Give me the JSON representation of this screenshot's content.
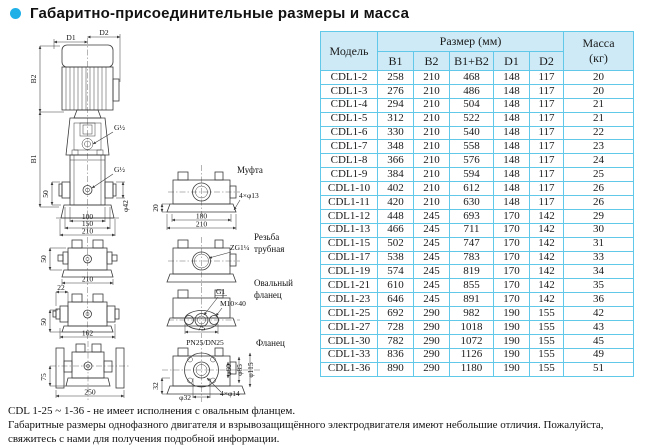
{
  "title": "Габаритно-присоединительные размеры и масса",
  "colors": {
    "accent": "#1fb0e8",
    "table_border": "#62c8ea",
    "header_fill": "#cdeaf6"
  },
  "table": {
    "header": {
      "model": "Модель",
      "size_group": "Размер (мм)",
      "cols": [
        "B1",
        "B2",
        "B1+B2",
        "D1",
        "D2"
      ],
      "mass1": "Масса",
      "mass2": "(кг)"
    },
    "rows": [
      [
        "CDL1-2",
        258,
        210,
        468,
        148,
        117,
        20
      ],
      [
        "CDL1-3",
        276,
        210,
        486,
        148,
        117,
        20
      ],
      [
        "CDL1-4",
        294,
        210,
        504,
        148,
        117,
        21
      ],
      [
        "CDL1-5",
        312,
        210,
        522,
        148,
        117,
        21
      ],
      [
        "CDL1-6",
        330,
        210,
        540,
        148,
        117,
        22
      ],
      [
        "CDL1-7",
        348,
        210,
        558,
        148,
        117,
        23
      ],
      [
        "CDL1-8",
        366,
        210,
        576,
        148,
        117,
        24
      ],
      [
        "CDL1-9",
        384,
        210,
        594,
        148,
        117,
        25
      ],
      [
        "CDL1-10",
        402,
        210,
        612,
        148,
        117,
        26
      ],
      [
        "CDL1-11",
        420,
        210,
        630,
        148,
        117,
        26
      ],
      [
        "CDL1-12",
        448,
        245,
        693,
        170,
        142,
        29
      ],
      [
        "CDL1-13",
        466,
        245,
        711,
        170,
        142,
        30
      ],
      [
        "CDL1-15",
        502,
        245,
        747,
        170,
        142,
        31
      ],
      [
        "CDL1-17",
        538,
        245,
        783,
        170,
        142,
        33
      ],
      [
        "CDL1-19",
        574,
        245,
        819,
        170,
        142,
        34
      ],
      [
        "CDL1-21",
        610,
        245,
        855,
        170,
        142,
        35
      ],
      [
        "CDL1-23",
        646,
        245,
        891,
        170,
        142,
        36
      ],
      [
        "CDL1-25",
        692,
        290,
        982,
        190,
        155,
        42
      ],
      [
        "CDL1-27",
        728,
        290,
        1018,
        190,
        155,
        43
      ],
      [
        "CDL1-30",
        782,
        290,
        1072,
        190,
        155,
        45
      ],
      [
        "CDL1-33",
        836,
        290,
        1126,
        190,
        155,
        49
      ],
      [
        "CDL1-36",
        890,
        290,
        1180,
        190,
        155,
        51
      ]
    ]
  },
  "drawing": {
    "labels": {
      "d1": "D1",
      "d2": "D2",
      "b2": "B2",
      "b1": "B1",
      "g_top": "G½",
      "g_mid": "G½",
      "n50a": "50",
      "n100": "100",
      "n150": "150",
      "n210a": "210",
      "phi42": "φ42",
      "n20": "20",
      "mufta": "Муфта",
      "bolt13": "4×φ13",
      "n180": "180",
      "n210b": "210",
      "rezba1": "Резьба",
      "rezba2": "трубная",
      "zg": "ZG1¼",
      "oval1": "Овальный",
      "oval2": "фланец",
      "g1": "G1",
      "m10": "M10×40",
      "n75a": "75",
      "pn": "PN25/DN25",
      "flanets": "Фланец",
      "n32": "32",
      "phi60": "φ60",
      "phi85": "φ85",
      "phi115": "φ115",
      "phi32": "φ32",
      "bolt14": "4×φ14",
      "n50b": "50",
      "n210c": "210",
      "n22": "22",
      "n50c": "50",
      "n162": "162",
      "n75b": "75",
      "n250": "250"
    }
  },
  "notes": {
    "line1": "CDL 1-25 ~ 1-36 - не имеет исполнения с овальным фланцем.",
    "line2": "Габаритные размеры однофазного двигателя и взрывозащищённого электродвигателя имеют небольшие отличия. Пожалуйста, свяжитесь с нами для получения подробной информации."
  }
}
